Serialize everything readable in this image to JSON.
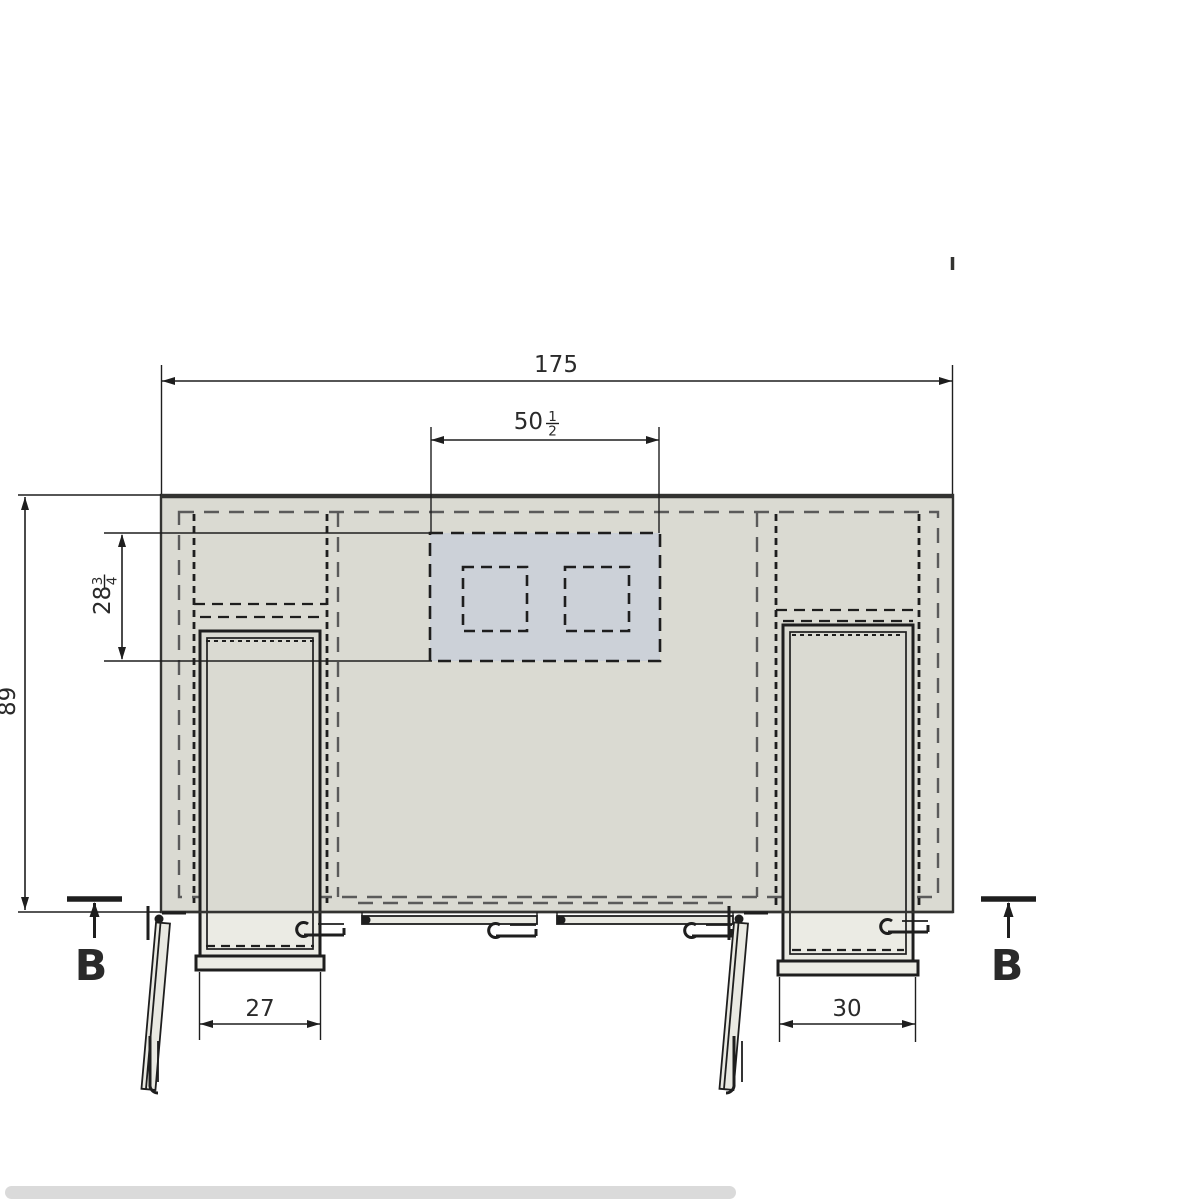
{
  "drawing": {
    "view": "cabinet-plan-top-view",
    "dims": {
      "overall_width": {
        "value": "175"
      },
      "cutout_width": {
        "whole": "50",
        "num": "1",
        "den": "2"
      },
      "overall_depth": {
        "value": "89"
      },
      "cutout_depth": {
        "whole": "28",
        "num": "3",
        "den": "4"
      },
      "left_unit_width": {
        "value": "27"
      },
      "right_unit_width": {
        "value": "30"
      }
    },
    "markers": {
      "section_left": "B",
      "section_right": "B"
    }
  },
  "colors": {
    "bg": "#ffffff",
    "ink": "#1e1e1e",
    "edge": "#333331",
    "text": "#2a2a2a",
    "dash": "#5a5a5a",
    "slab": "#dadad2",
    "zone": "#ccd1d8",
    "lite": "#ebebe4",
    "door": "#e9e9e2",
    "bar": "#dadada"
  }
}
